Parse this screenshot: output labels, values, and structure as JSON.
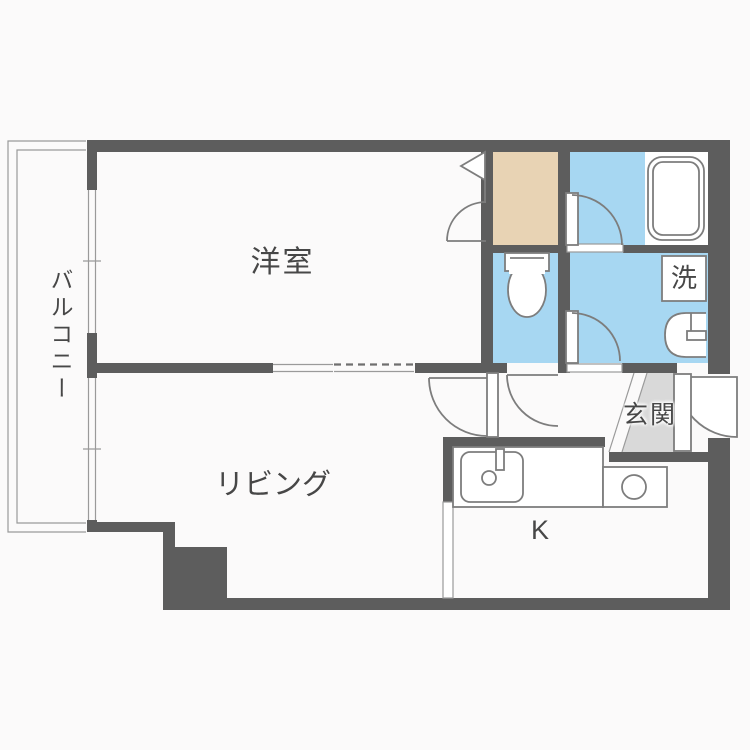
{
  "title": "1LDK apartment floor plan",
  "labels": {
    "balcony": "バルコニー",
    "western_room": "洋室",
    "living": "リビング",
    "entrance": "玄関",
    "kitchen": "K",
    "laundry": "洗"
  },
  "rooms": [
    {
      "id": "balcony",
      "label": "バルコニー"
    },
    {
      "id": "western-room",
      "label": "洋室"
    },
    {
      "id": "living",
      "label": "リビング"
    },
    {
      "id": "kitchen",
      "label": "K"
    },
    {
      "id": "entrance",
      "label": "玄関"
    },
    {
      "id": "closet",
      "label": ""
    },
    {
      "id": "bathroom",
      "label": ""
    },
    {
      "id": "toilet",
      "label": ""
    },
    {
      "id": "washroom",
      "label": "洗"
    }
  ],
  "colors": {
    "wall": "#5d5d5d",
    "wet_area_floor": "#a7d7f2",
    "closet_floor": "#e8d3b4",
    "entrance_floor": "#d9d9d9",
    "line": "#7d7d7d",
    "background": "#fbfafa",
    "text": "#474747"
  }
}
